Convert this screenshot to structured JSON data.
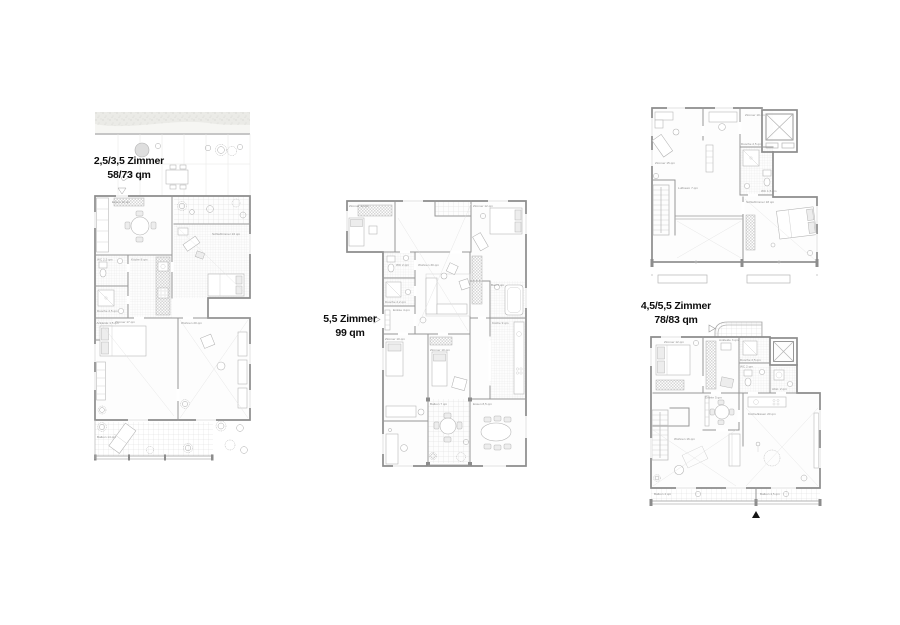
{
  "plans": {
    "left": {
      "title": "2,5/3,5 Zimmer",
      "area": "58/73 qm",
      "rooms": {
        "essen": "Essen 10 qm",
        "schlafzimmer": "Schlafzimmer 16 qm",
        "wc": "WC 2,5 qm",
        "dusche": "Dusche 2,5 qm",
        "kueche": "Küche 8 qm",
        "ankleide": "Ankleide 1,5 qm",
        "zimmer": "Zimmer 17 qm",
        "wohnen": "Wohnen 20 qm",
        "balkon": "Balkon 14 qm"
      }
    },
    "middle": {
      "title": "5,5 Zimmer",
      "area": "99 qm",
      "rooms": {
        "zimmer1": "Zimmer 12 qm",
        "zimmer2": "Zimmer 12 qm",
        "wohnen": "Wohnen 30 qm",
        "wc": "WC 2 qm",
        "dusche": "Dusche 2,2 qm",
        "entree": "Entrée 4 qm",
        "zimmer3": "Zimmer 10 qm",
        "zimmer4": "Zimmer 10 qm",
        "bad": "Bad 5 qm",
        "kueche": "Küche 9 qm",
        "balkon": "Balkon 7 qm",
        "essen": "Essen 8,5 qm"
      }
    },
    "right": {
      "title": "4,5/5,5 Zimmer",
      "area": "78/83 qm",
      "upper_rooms": {
        "zimmer1": "Zimmer 15 qm",
        "zimmer2": "Zimmer 10 qm",
        "dusche": "Dusche 2,5 qm",
        "wc": "WC 1,5 qm",
        "schlafzimmer": "Schlafzimmer 18 qm",
        "luftraum": "Luftraum 7 qm"
      },
      "lower_rooms": {
        "zimmer": "Zimmer 12 qm",
        "ankleide": "Ankleide 3 qm",
        "dusche": "Dusche 2,5 qm",
        "wc": "WC 2 qm",
        "abstell": "Abst. 2 qm",
        "entree": "Entrée 5 qm",
        "wohnen": "Wohnen 16 qm",
        "kueche": "Küche/Essen 20 qm",
        "balkon1": "Balkon 4 qm",
        "balkon2": "Balkon 4,5 qm"
      }
    }
  },
  "symbols": {
    "north_triangle": "▲"
  },
  "colors": {
    "wall": "#8c8c8c",
    "furniture": "#b2b2b2",
    "tile": "#d9d9d9",
    "title_text": "#0d0d0d",
    "background": "#ffffff"
  }
}
